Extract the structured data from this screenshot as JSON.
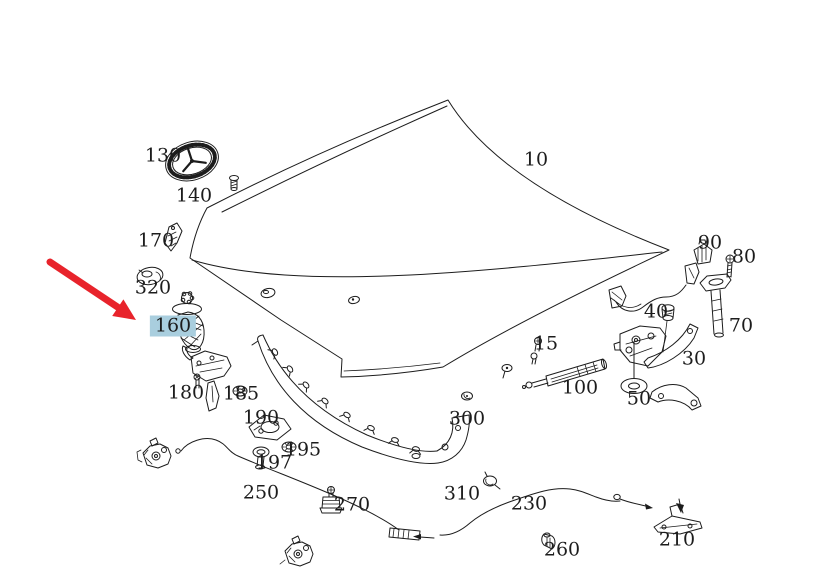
{
  "diagram": {
    "description": "Exploded parts diagram of a car hood assembly with Mercedes star emblem",
    "background_color": "#ffffff",
    "line_color": "#1c1c1c",
    "colors": {
      "highlight": "#a9cede",
      "arrow": "#e8232b",
      "label_text": "#1c1c1c"
    },
    "selected_part": "160",
    "annotation": {
      "type": "arrow",
      "points_to_label": "160"
    },
    "labels": [
      {
        "text": "10",
        "x": 536,
        "y": 160,
        "highlighted": false
      },
      {
        "text": "130",
        "x": 163,
        "y": 156,
        "highlighted": false
      },
      {
        "text": "140",
        "x": 194,
        "y": 196,
        "highlighted": false
      },
      {
        "text": "170",
        "x": 156,
        "y": 241,
        "highlighted": false
      },
      {
        "text": "320",
        "x": 153,
        "y": 288,
        "highlighted": false
      },
      {
        "text": "160",
        "x": 173,
        "y": 326,
        "highlighted": true
      },
      {
        "text": "180",
        "x": 186,
        "y": 393,
        "highlighted": false
      },
      {
        "text": "185",
        "x": 241,
        "y": 394,
        "highlighted": false
      },
      {
        "text": "190",
        "x": 261,
        "y": 418,
        "highlighted": false
      },
      {
        "text": "195",
        "x": 303,
        "y": 450,
        "highlighted": false
      },
      {
        "text": "197",
        "x": 274,
        "y": 463,
        "highlighted": false
      },
      {
        "text": "250",
        "x": 261,
        "y": 493,
        "highlighted": false
      },
      {
        "text": "270",
        "x": 352,
        "y": 505,
        "highlighted": false
      },
      {
        "text": "300",
        "x": 467,
        "y": 419,
        "highlighted": false
      },
      {
        "text": "310",
        "x": 462,
        "y": 494,
        "highlighted": false
      },
      {
        "text": "230",
        "x": 529,
        "y": 504,
        "highlighted": false
      },
      {
        "text": "260",
        "x": 562,
        "y": 550,
        "highlighted": false
      },
      {
        "text": "210",
        "x": 677,
        "y": 540,
        "highlighted": false
      },
      {
        "text": "15",
        "x": 546,
        "y": 344,
        "highlighted": false
      },
      {
        "text": "100",
        "x": 580,
        "y": 388,
        "highlighted": false
      },
      {
        "text": "50",
        "x": 639,
        "y": 399,
        "highlighted": false
      },
      {
        "text": "30",
        "x": 694,
        "y": 359,
        "highlighted": false
      },
      {
        "text": "40",
        "x": 656,
        "y": 312,
        "highlighted": false
      },
      {
        "text": "70",
        "x": 741,
        "y": 326,
        "highlighted": false
      },
      {
        "text": "80",
        "x": 744,
        "y": 257,
        "highlighted": false
      },
      {
        "text": "90",
        "x": 710,
        "y": 243,
        "highlighted": false
      }
    ]
  }
}
